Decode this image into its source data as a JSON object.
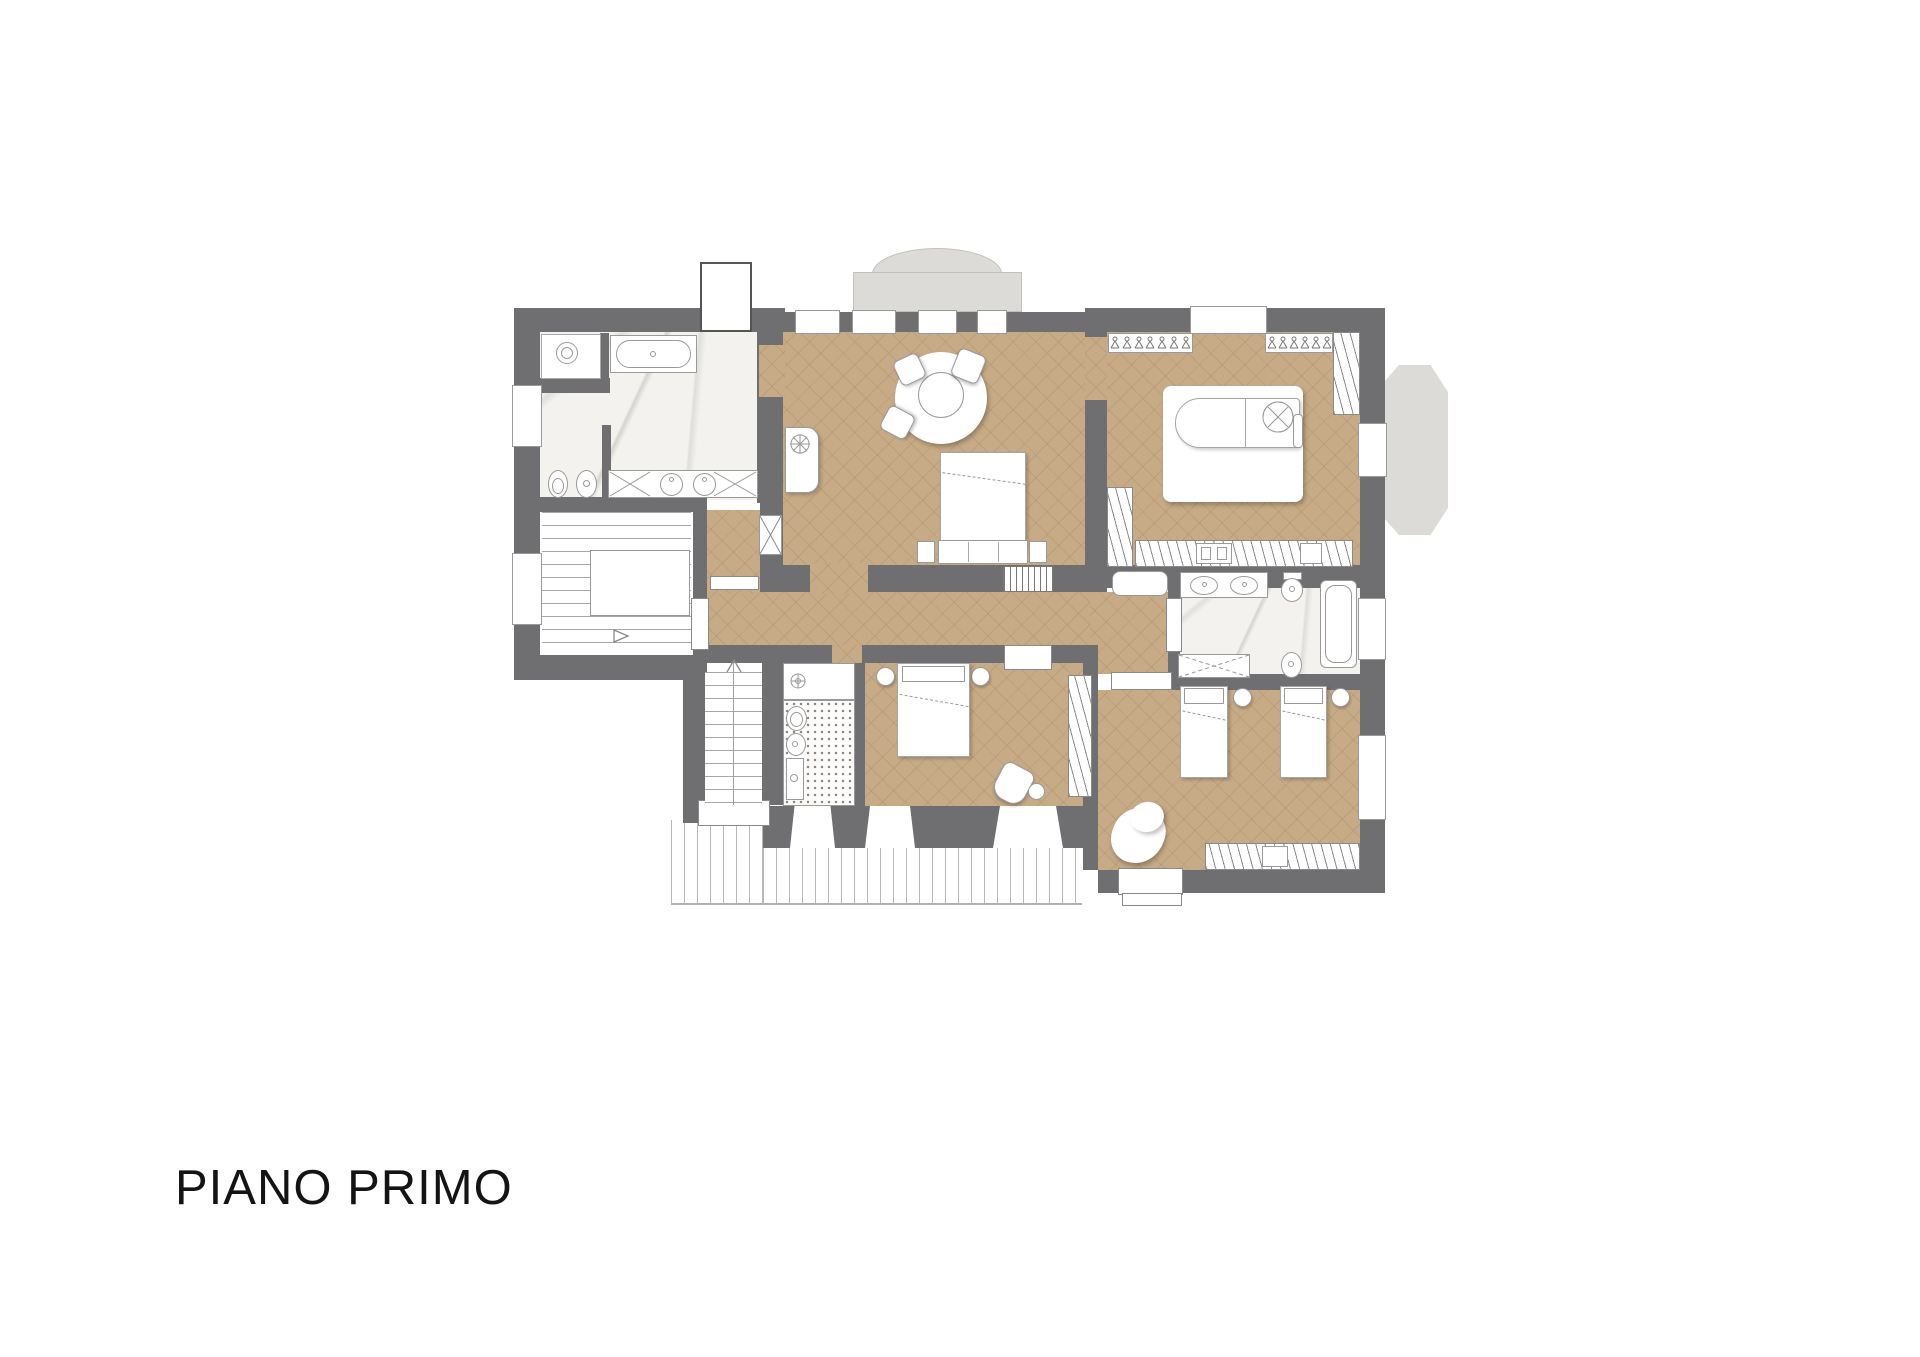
{
  "title": "PIANO PRIMO",
  "colors": {
    "wall": "#6f6f71",
    "wood_floor": "#c7ab86",
    "marble_floor": "#f3f2ee",
    "concrete": "#dcdbd7",
    "background": "#ffffff",
    "text": "#141414"
  },
  "icons": {
    "hanger_rows": [
      {
        "name": "wardrobe-hangers-left",
        "count": 7
      },
      {
        "name": "wardrobe-hangers-right",
        "count": 6
      }
    ],
    "stair_up_arrow": "triangle-up",
    "stair_dir_arrow": "triangle-right",
    "vent_fan": "circle-x-fan",
    "shower_cross": "dashed-x",
    "duct_cross": "x"
  }
}
